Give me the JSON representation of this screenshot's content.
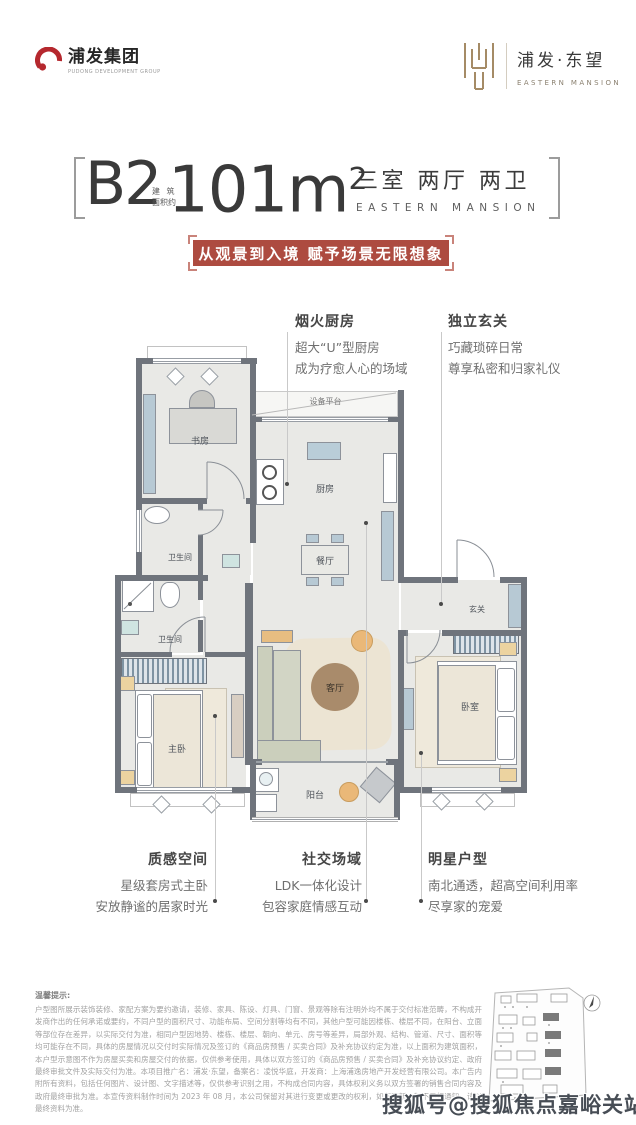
{
  "header": {
    "group_logo": {
      "name": "浦发集团",
      "subtitle": "PUDONG DEVELOPMENT GROUP"
    },
    "brand_logo": {
      "name": "浦发·东望",
      "subtitle": "EASTERN MANSION"
    }
  },
  "title_block": {
    "unit": "B2",
    "area_label_top": "建 筑",
    "area_label_bottom": "面积约",
    "area_value": "101m",
    "area_sup": "2",
    "layout": "三室 两厅 两卫",
    "layout_sub": "EASTERN MANSION"
  },
  "banner": {
    "text": "从观景到入境 赋予场景无限想象",
    "bg": "#ad4b40"
  },
  "callouts": {
    "kitchen": {
      "title": "烟火厨房",
      "line1": "超大“U”型厨房",
      "line2": "成为疗愈人心的场域"
    },
    "entry": {
      "title": "独立玄关",
      "line1": "巧藏琐碎日常",
      "line2": "尊享私密和归家礼仪"
    },
    "master": {
      "title": "质感空间",
      "line1": "星级套房式主卧",
      "line2": "安放静谧的居家时光"
    },
    "social": {
      "title": "社交场域",
      "line1": "LDK一体化设计",
      "line2": "包容家庭情感互动"
    },
    "star": {
      "title": "明星户型",
      "line1": "南北通透，超高空间利用率",
      "line2": "尽享家的宠爱"
    }
  },
  "floorplan": {
    "rooms": {
      "study": "书房",
      "bath1": "卫生间",
      "bath2": "卫生间",
      "equipment": "设备平台",
      "kitchen": "厨房",
      "dining": "餐厅",
      "living": "客厅",
      "balcony": "阳台",
      "entry": "玄关",
      "bedroom": "卧室",
      "master": "主卧"
    }
  },
  "disclaimer": {
    "title": "温馨提示:",
    "body": "户型图所展示装饰装修、家配方案为要约邀请，装修、家具、陈设、灯具、门窗、景观等除有注明外均不属于交付标准范畴，不构成开发商作出的任何承诺或要约，不同户型的面积尺寸、功能布局、空间分割等均有不同，其他户型可能因楼栋、楼层不同，在阳台、立面等部位存在差异，以实际交付为准，相同户型因地势、楼栋、楼层、朝向、单元、房号等差异，局部外观、结构、管道、尺寸、面积等均可能存在不同，具体的房屋情况以交付时实际情况及签订的《商品房预售 / 买卖合同》及补充协议约定为准，以上面积为建筑面积，本户型示意图不作为房屋买卖和房屋交付的依据，仅供参考使用，具体以双方签订的《商品房预售 / 买卖合同》及补充协议约定、政府最终审批文件及实际交付为准。本项目推广名：浦发·东望，备案名：凌悦华庭，开发商：上海浦逸房地产开发经营有限公司。本广告内附所有资料，包括任何图片、设计图、文字描述等，仅供参考识别之用，不构成合同内容，具体权利义务以双方签署的销售合同内容及政府最终审批为准。本宣传资料制作时间为 2023 年 08 月，本公司保留对其进行变更或更改的权利，如有更新，恕不另行通知，请以最终资料为准。"
  },
  "watermark": "搜狐号@搜狐焦点嘉峪关站",
  "colors": {
    "accent_red": "#ad4b40",
    "wall_gray": "#6f747c",
    "brand_gold": "#a58b66",
    "floor": "#e9e9e6"
  }
}
